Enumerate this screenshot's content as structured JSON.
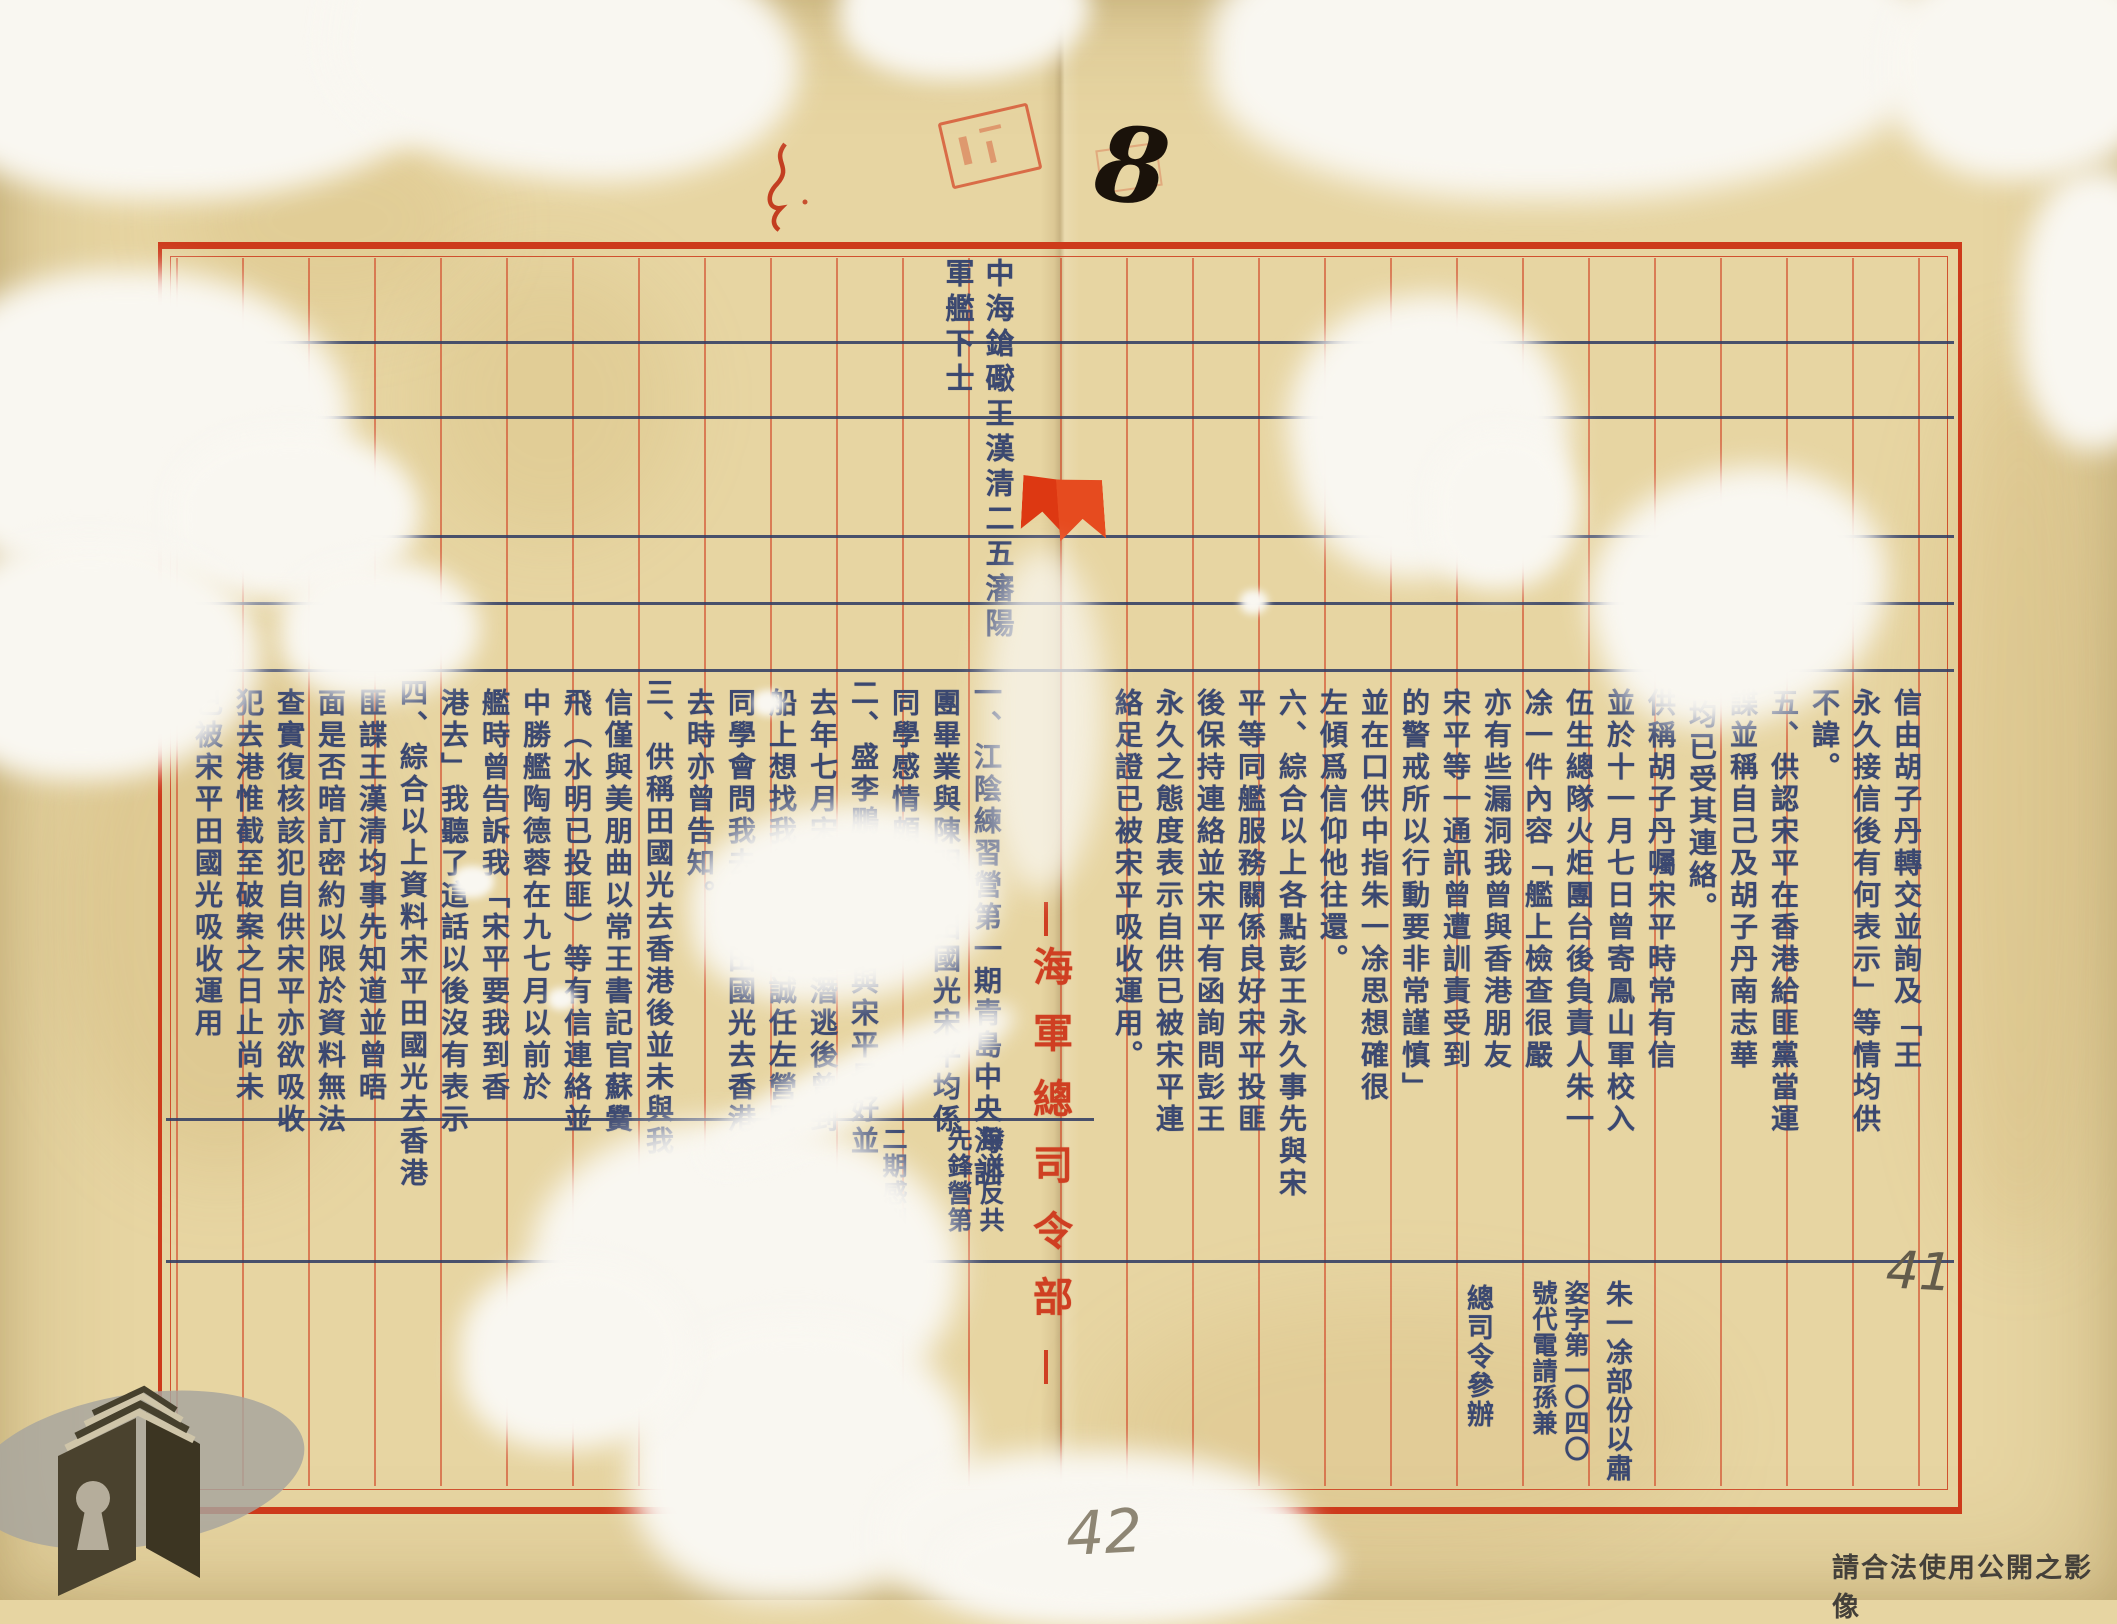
{
  "doc": {
    "title_spine": "海軍總司令部",
    "header": {
      "col_right": "中海鎗礮王漢清二五瀋陽",
      "col_left": "軍艦下士"
    },
    "left_cols": [
      "一、江陰練習營第一期青島中央海訓",
      "團畢業與陳明誠田國光宋平均係",
      "同學感情頗洽。",
      "二、盛李鵬供王漢清與宋平最好並",
      "去年七月宋平於定海潛逃後曾到",
      "船上想找我並云陳明誠任左營開",
      "同學會問我去不去田國光去香港",
      "去時亦曾告知。",
      "三、供稱田國光去香港後並未與我",
      "信僅與美朋曲以常王書記官蘇黌",
      "飛（水明已投匪）等有信連絡並",
      "中勝艦陶德蓉在九七月以前於",
      "艦時曾告訴我「宋平要我到香",
      "港去」我聽了這話以後沒有表示",
      "四、綜合以上資料宋平田國光去香港",
      "匪諜王漢清均事先知道並曾晤",
      "面是否暗訂密約以限於資料無法",
      "查實復核該犯自供宋平亦欲吸收",
      "犯去港惟截至破案之日止尚未",
      "己被宋平田國光吸收運用"
    ],
    "note_cols": [
      "撥送反共",
      "先鋒營第",
      "二期感訓"
    ],
    "right_cols": [
      "信由胡子丹轉交並詢及「王",
      "永久接信後有何表示」等情均供",
      "不諱。",
      "五、供認宋平在香港給匪黨當運",
      "諜並稱自己及胡子丹南志華",
      "均已受其連絡。",
      "供稱胡子丹囑宋平時常有信",
      "並於十一月七日曾寄鳳山軍校入",
      "伍生總隊火炬團台後負責人朱一",
      "凃一件內容「艦上檢查很嚴",
      "亦有些漏洞我曾與香港朋友",
      "宋平等一通訊曾遭訓責受到",
      "的警戒所以行動要非常謹慎」",
      "並在口供中指朱一凃思想確很",
      "左傾爲信仰他往還。",
      "六、綜合以上各點彭王永久事先與宋",
      "平等同艦服務關係良好宋平投匪",
      "後保持連絡並宋平有函詢問彭王",
      "永久之態度表示自供已被宋平連",
      "絡足證已被宋平吸收運用。"
    ],
    "signature_cols": [
      "朱一凃部份以肅",
      "姿字第一〇四〇",
      "號代電請孫兼",
      "總司令參辦"
    ],
    "handwriting": {
      "top_number": "8",
      "bottom_center_number": "42",
      "bottom_right_number": "41"
    },
    "watermark": "請合法使用公開之影像",
    "colors": {
      "paper": "#e7d5a2",
      "grid_red": "#cd3a1b",
      "ink_navy": "#3b4870",
      "spine_red": "#cf3f22",
      "pencil_grey": "#8e8674",
      "watermark_grey": "#44403a"
    }
  }
}
